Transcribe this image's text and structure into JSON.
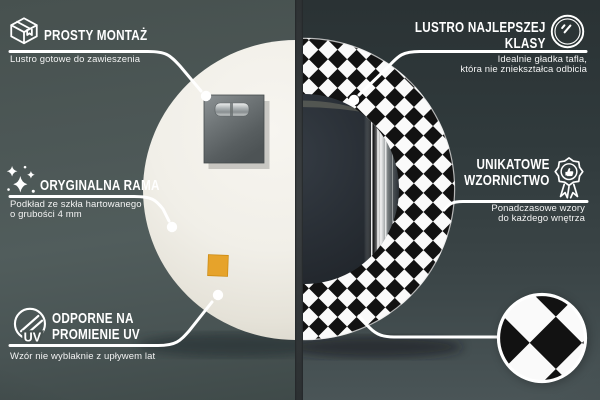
{
  "callouts": {
    "easy_mount": {
      "title": "PROSTY MONTAŻ",
      "subtitle": "Lustro gotowe do zawieszenia",
      "icon": "package-box-icon"
    },
    "top_quality": {
      "title_line1": "LUSTRO NAJLEPSZEJ",
      "title_line2": "KLASY",
      "subtitle_line1": "Idealnie gładka tafla,",
      "subtitle_line2": "która nie zniekształca odbicia",
      "icon": "mirror-shine-icon"
    },
    "original_frame": {
      "title": "ORYGINALNA RAMA",
      "subtitle_line1": "Podkład ze szkła hartowanego",
      "subtitle_line2": "o grubości 4 mm",
      "icon": "sparkles-icon"
    },
    "unique_design": {
      "title_line1": "UNIKATOWE",
      "title_line2": "WZORNICTWO",
      "subtitle_line1": "Ponadczasowe wzory",
      "subtitle_line2": "do każdego wnętrza",
      "icon": "award-badge-icon"
    },
    "uv_resistant": {
      "title_line1": "ODPORNE NA",
      "title_line2": "PROMIENIE UV",
      "subtitle": "Wzór nie wyblaknie z upływem lat",
      "icon": "uv-circle-icon",
      "icon_label": "UV"
    }
  },
  "colors": {
    "callout_white": "#ffffff",
    "bg_left": "#4c5756",
    "bg_right_top": "#2b3335",
    "bg_right_bottom": "#4a5557",
    "divider": "#35393b",
    "mirror_back_cream": "#f2f0ea",
    "pattern_black": "#121212",
    "pattern_white": "#fafafa",
    "sticker_orange": "#e6a32b",
    "mount_plate_gray": "#6f7577",
    "mirror_face_dark": "#272c33"
  },
  "scene": {
    "left_panel": "mirror back view",
    "right_panel": "mirror front view with checkered frame",
    "detail_swatch": "checkered pattern close-up"
  }
}
